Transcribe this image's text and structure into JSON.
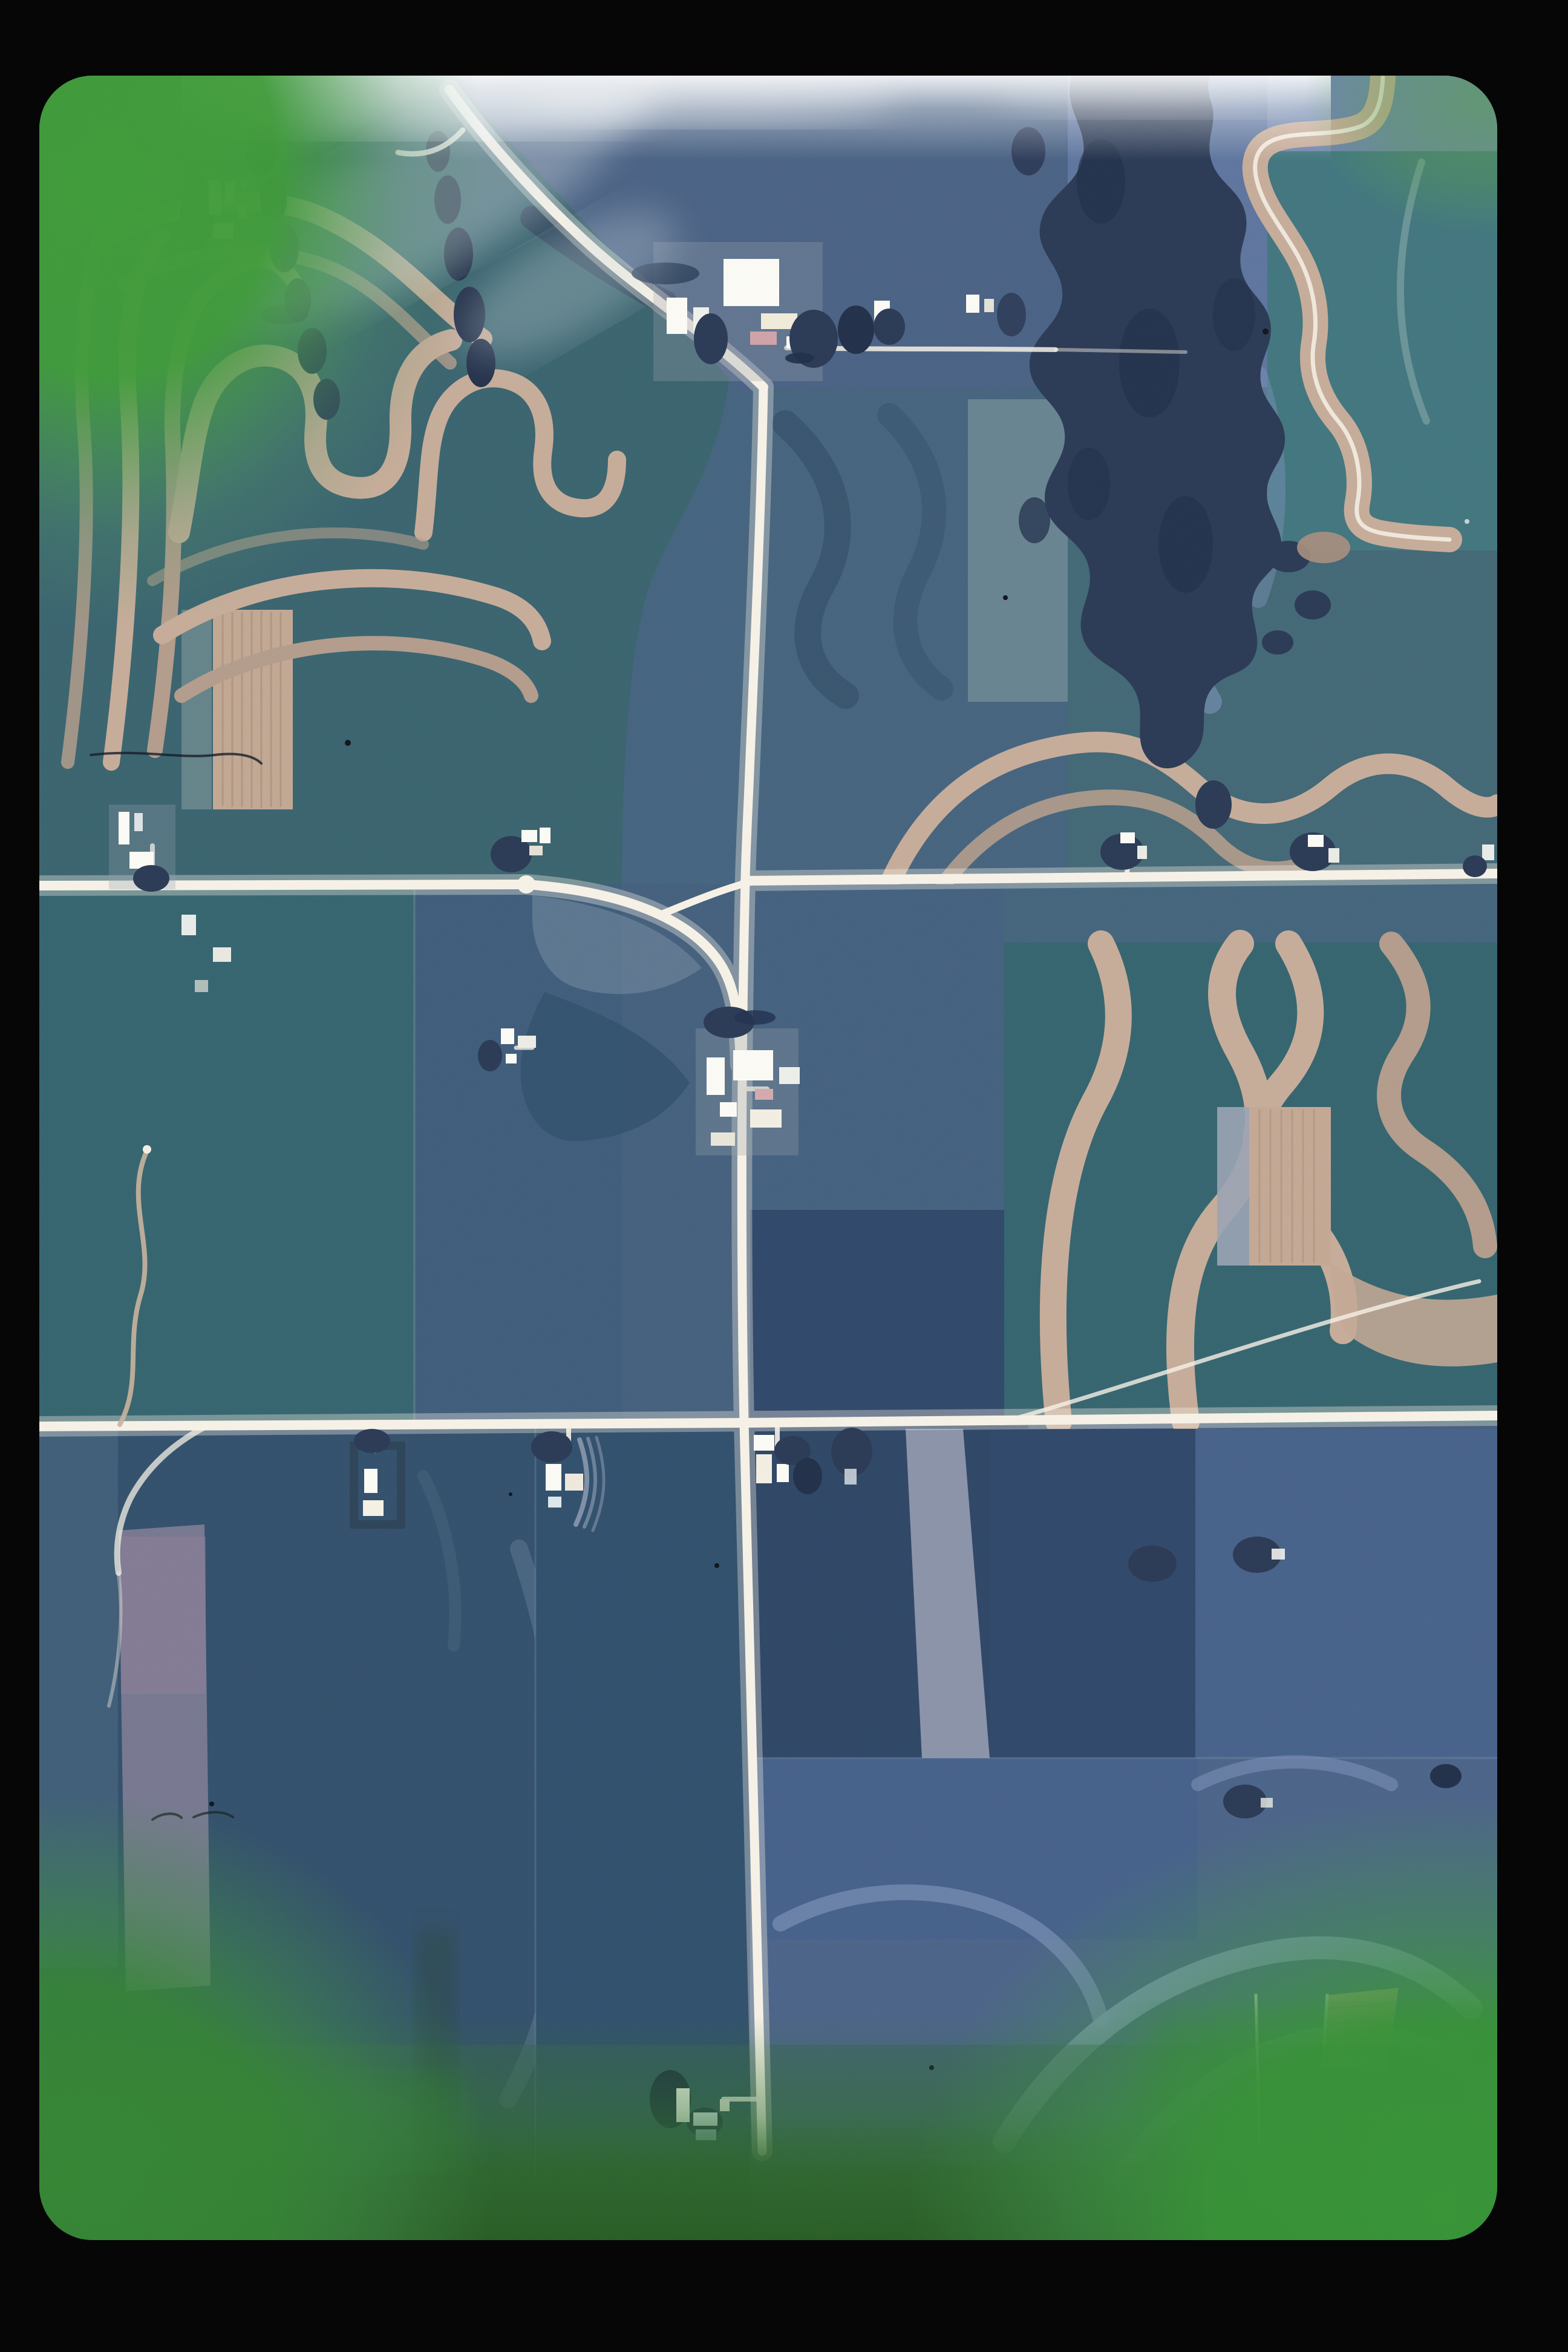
{
  "title": "Aerial photo slide - farmland with contour strip cropping",
  "description": "Color slide scan of a vertical aerial photograph of midwestern farmland: contour strip-cropped hillsides, a rural section-road grid, scattered farmsteads with white buildings, woodland along drainages; green film-edge fog in the corners, a white light leak along the top edge, and a black slide-mount border.",
  "palette": {
    "mount": "#060607",
    "base": "#44607d",
    "teal": "#3a646f",
    "teal_deep": "#2f5a66",
    "slate": "#4a6284",
    "slate_light": "#5e759e",
    "pale_blue": "#7e93b8",
    "navy": "#32496b",
    "navy_dark": "#2c3f5e",
    "strip_tan": "#c6ac99",
    "strip_tan_soft": "#b39c8c",
    "strip_blue": "#8296bd",
    "road_white": "#f6f1e6",
    "building": "#fbfaf5",
    "tree": "#2b3a55",
    "tree_dark": "#22304a",
    "green_bright": "#3f9b39",
    "green_mid": "#3f8f3c",
    "green_dark": "#2d6429",
    "purple_field": "#6e5a73",
    "mauve_strip": "#7d7c94",
    "gray_strip": "#8b93a9",
    "glow": "#ffffff"
  },
  "features": {
    "photo": {
      "label": "aerial photograph of farmland"
    },
    "roads": {
      "label": "gravel road network"
    },
    "strips": {
      "label": "contour strip-cropped hillsides"
    },
    "fields": {
      "label": "rectangular row-crop fields"
    },
    "farmsteads": {
      "label": "farmsteads with white buildings and windbreaks"
    },
    "woodland": {
      "label": "woodland along drainage"
    },
    "film": {
      "label": "slide film frame with green edge fog, light leak, dust and black mount"
    }
  }
}
